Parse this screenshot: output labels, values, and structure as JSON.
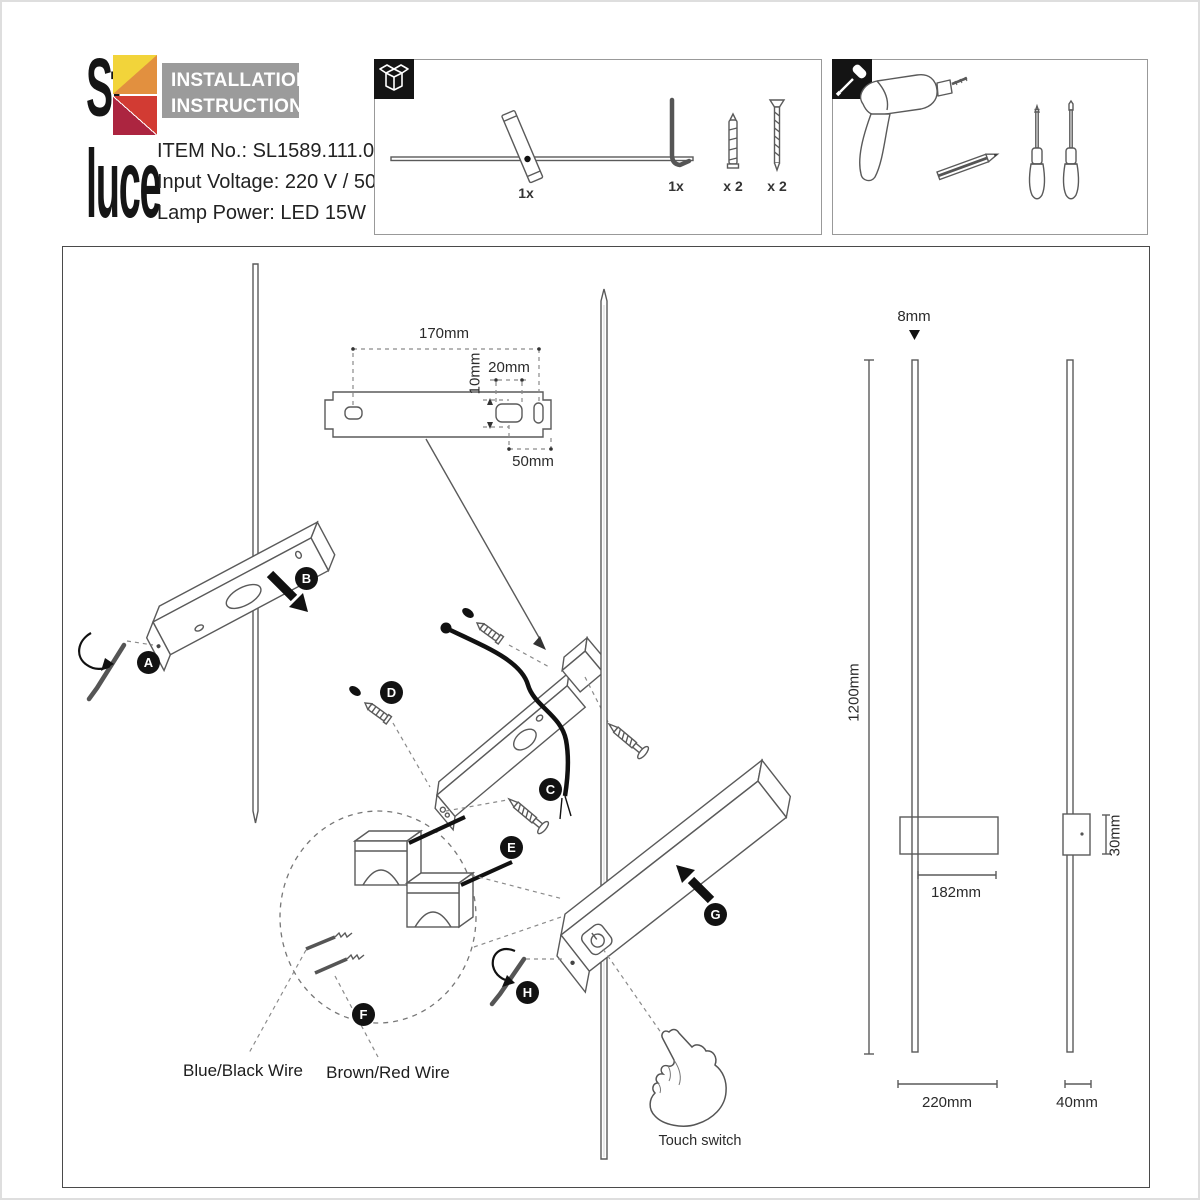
{
  "header": {
    "logo_top": "St",
    "logo_bottom": "luce",
    "title1": "INSTALLATION",
    "title2": "INSTRUCTIONS",
    "item": "ITEM No.: SL1589.111.01",
    "voltage": "Input Voltage: 220 V / 50Hz",
    "power": "Lamp Power: LED 15W"
  },
  "contents": {
    "qty_lamp": "1x",
    "qty_hex_key": "1x",
    "qty_wall_plug": "x 2",
    "qty_screw": "x 2"
  },
  "steps": {
    "a": "A",
    "b": "B",
    "c": "C",
    "d": "D",
    "e": "E",
    "f": "F",
    "g": "G",
    "h": "H"
  },
  "dims": {
    "bracket_width": "170mm",
    "bracket_voffset": "10mm",
    "hole_width": "20mm",
    "right_offset": "50mm",
    "rod_diameter": "8mm",
    "total_height": "1200mm",
    "body_front_width": "182mm",
    "body_side_depth": "30mm",
    "front_width": "220mm",
    "side_width": "40mm"
  },
  "labels": {
    "wire_blue": "Blue/Black Wire",
    "wire_brown": "Brown/Red Wire",
    "touch": "Touch switch"
  },
  "colors": {
    "logo_yellow": "#f2d43a",
    "logo_orange": "#e2903f",
    "logo_red": "#d23b33",
    "logo_darkred": "#ac2540",
    "header_gray": "#9b9b9b",
    "line_gray": "#5a5a5a"
  }
}
